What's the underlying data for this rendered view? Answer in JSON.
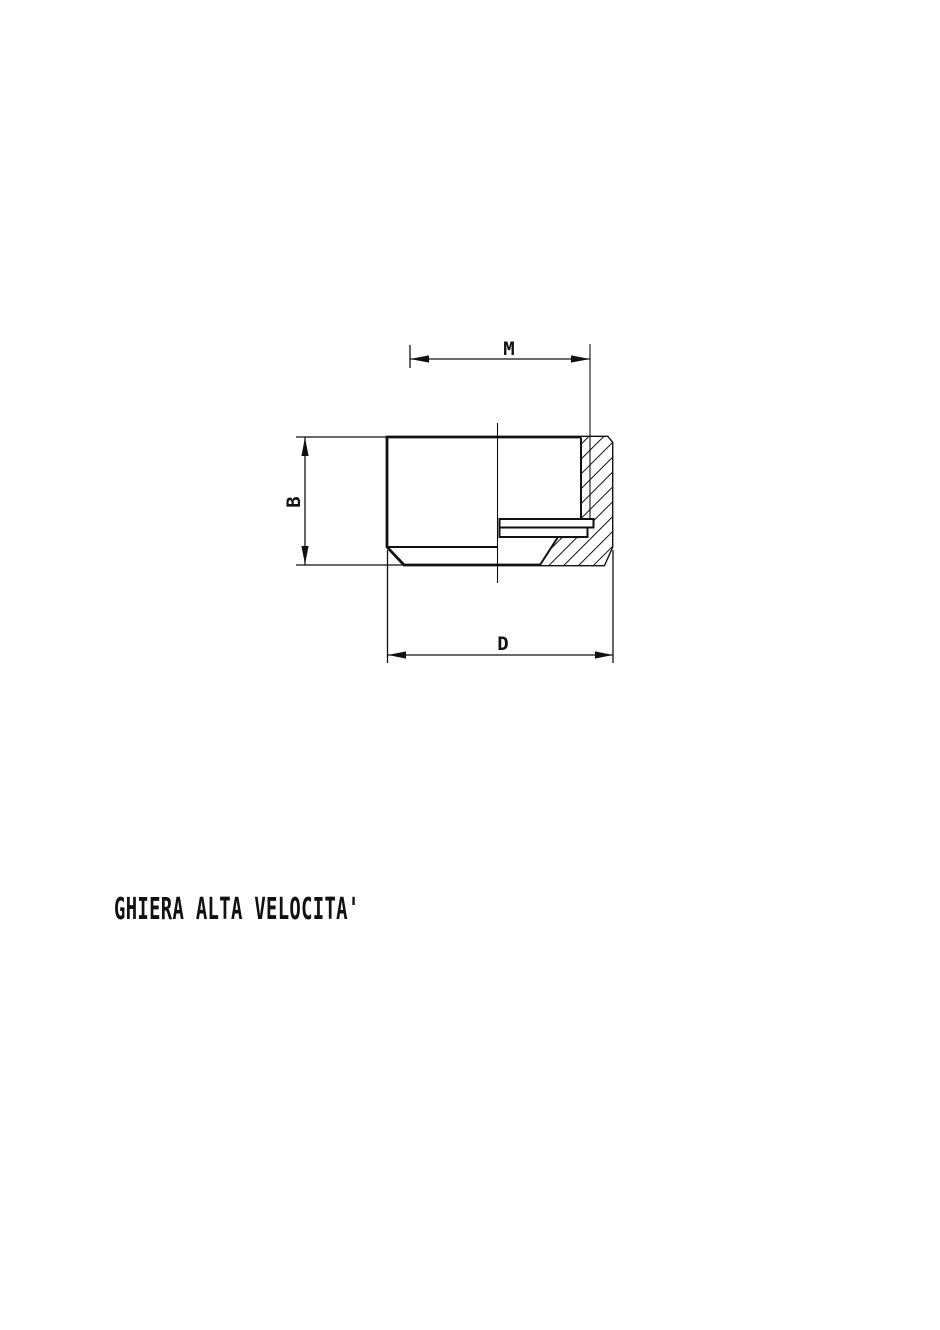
{
  "page": {
    "background": "#ffffff",
    "ink": "#111111"
  },
  "drawing": {
    "kind": "technical-drawing-cross-section",
    "caption": "GHIERA ALTA VELOCITA'",
    "dimension_labels": {
      "thread": "M",
      "height": "B",
      "outer_diameter": "D"
    }
  }
}
